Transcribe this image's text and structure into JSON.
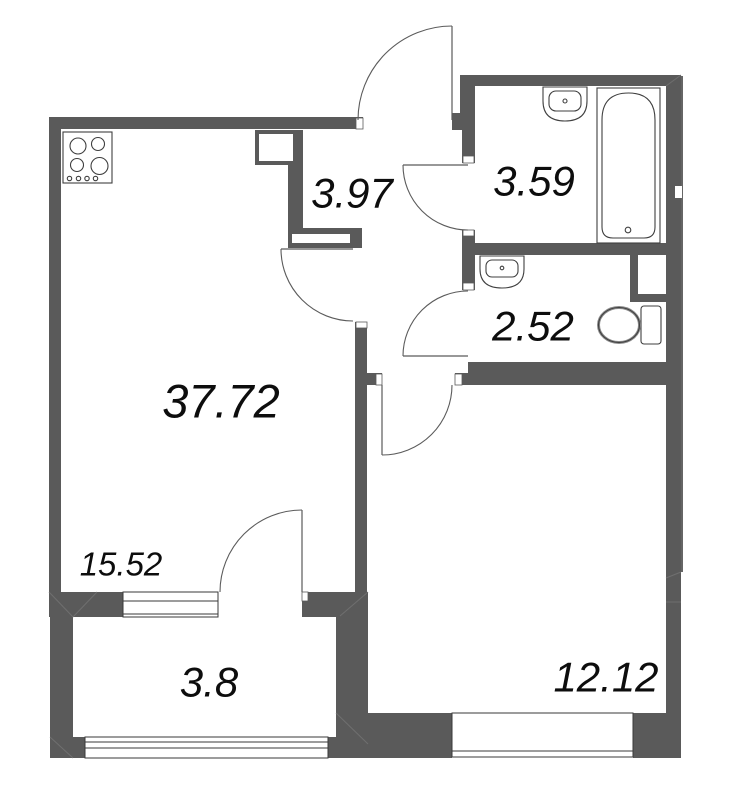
{
  "floorplan": {
    "type": "apartment-floor-plan",
    "colors": {
      "wall": "#5a5a5a",
      "background": "#ffffff",
      "door_arc": "#5b5b5b",
      "fixture_outline": "#3f3f3f",
      "label_text": "#0d0d0d"
    },
    "rooms": [
      {
        "name": "living-kitchen",
        "area": "37.72"
      },
      {
        "name": "hallway",
        "area": "3.97"
      },
      {
        "name": "bathroom",
        "area": "3.59"
      },
      {
        "name": "toilet-room",
        "area": "2.52"
      },
      {
        "name": "living-zone",
        "area": "15.52"
      },
      {
        "name": "balcony",
        "area": "3.8"
      },
      {
        "name": "bedroom",
        "area": "12.12"
      }
    ],
    "fixtures": [
      {
        "name": "stove-icon"
      },
      {
        "name": "bath-sink-icon"
      },
      {
        "name": "bathtub-icon"
      },
      {
        "name": "toilet-sink-icon"
      },
      {
        "name": "toilet-icon"
      },
      {
        "name": "duct-shaft"
      }
    ],
    "doors": 6,
    "windows": 3
  }
}
